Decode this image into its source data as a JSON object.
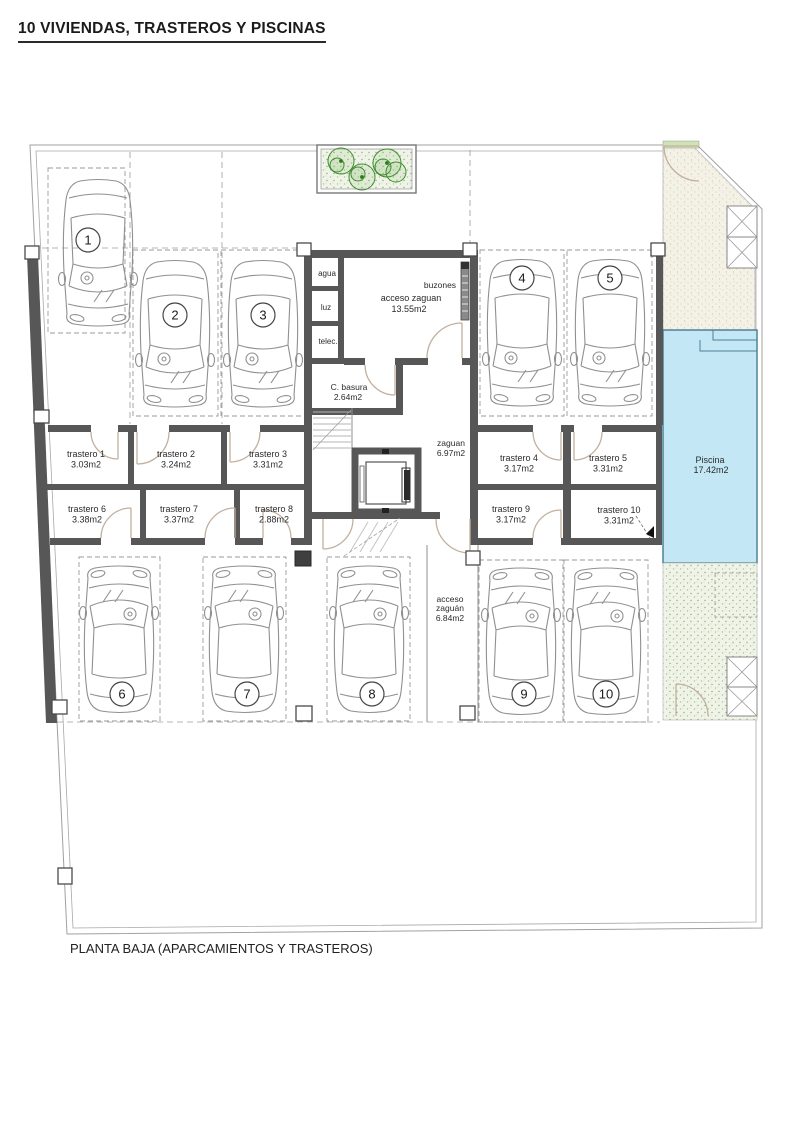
{
  "page": {
    "title": "10 VIVIENDAS, TRASTEROS Y PISCINAS",
    "caption": "PLANTA BAJA (APARCAMIENTOS Y TRASTEROS)"
  },
  "labels": {
    "agua": "agua",
    "luz": "luz",
    "telec": "telec.",
    "buzones": "buzones"
  },
  "rooms": {
    "acceso_zaguan": {
      "label": "acceso zaguan",
      "area": "13.55m2"
    },
    "c_basura": {
      "label": "C. basura",
      "area": "2.64m2"
    },
    "zaguan": {
      "label": "zaguan",
      "area": "6.97m2"
    },
    "acceso_sur": {
      "line1": "acceso",
      "line2": "zaguán",
      "area": "6.84m2"
    },
    "piscina": {
      "label": "Piscina",
      "area": "17.42m2"
    }
  },
  "trasteros": [
    {
      "label": "trastero 1",
      "area": "3.03m2"
    },
    {
      "label": "trastero 2",
      "area": "3.24m2"
    },
    {
      "label": "trastero 3",
      "area": "3.31m2"
    },
    {
      "label": "trastero 4",
      "area": "3.17m2"
    },
    {
      "label": "trastero 5",
      "area": "3.31m2"
    },
    {
      "label": "trastero 6",
      "area": "3.38m2"
    },
    {
      "label": "trastero 7",
      "area": "3.37m2"
    },
    {
      "label": "trastero 8",
      "area": "2.88m2"
    },
    {
      "label": "trastero 9",
      "area": "3.17m2"
    },
    {
      "label": "trastero 10",
      "area": "3.31m2"
    }
  ],
  "parking": [
    {
      "number": "1"
    },
    {
      "number": "2"
    },
    {
      "number": "3"
    },
    {
      "number": "4"
    },
    {
      "number": "5"
    },
    {
      "number": "6"
    },
    {
      "number": "7"
    },
    {
      "number": "8"
    },
    {
      "number": "9"
    },
    {
      "number": "10"
    }
  ],
  "colors": {
    "wall": "#575757",
    "pool_fill": "#c3e7f5",
    "pool_edge": "#4e8298",
    "garden_bg": "#f0f4e8",
    "terrace_bg": "#f4f1e6",
    "plant_green": "#3f8c2e",
    "door_tan": "#c2b09e"
  }
}
